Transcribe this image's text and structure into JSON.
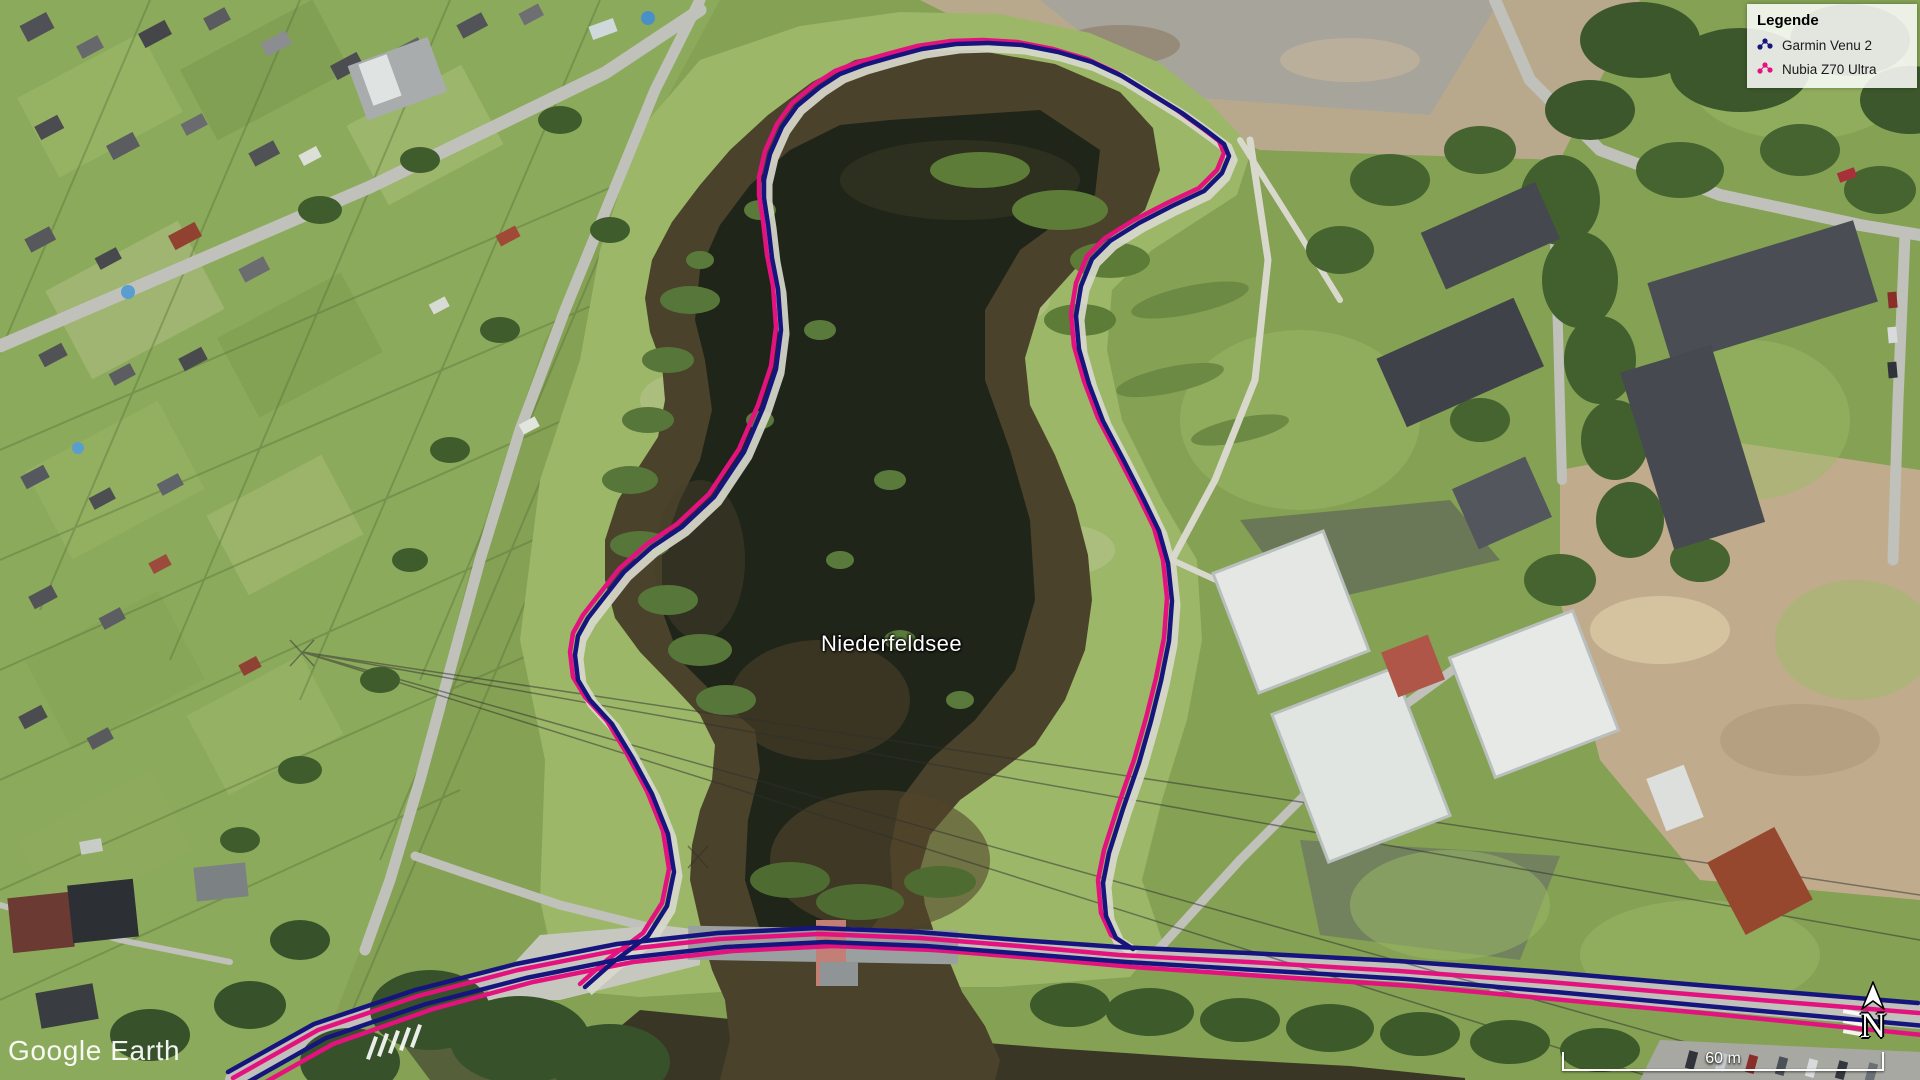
{
  "legend": {
    "title": "Legende",
    "items": [
      {
        "label": "Garmin Venu 2",
        "icon": "track-dots-icon"
      },
      {
        "label": "Nubia Z70 Ultra",
        "icon": "track-dots-icon"
      }
    ]
  },
  "map": {
    "place_label": "Niederfeldsee",
    "tracks": [
      {
        "device": "Garmin Venu 2",
        "color": "#15157d"
      },
      {
        "device": "Nubia Z70 Ultra",
        "color": "#e4127f"
      }
    ]
  },
  "watermark": {
    "text": "Google Earth"
  },
  "scale_bar": {
    "label": "60 m"
  },
  "compass": {
    "label": "N"
  }
}
